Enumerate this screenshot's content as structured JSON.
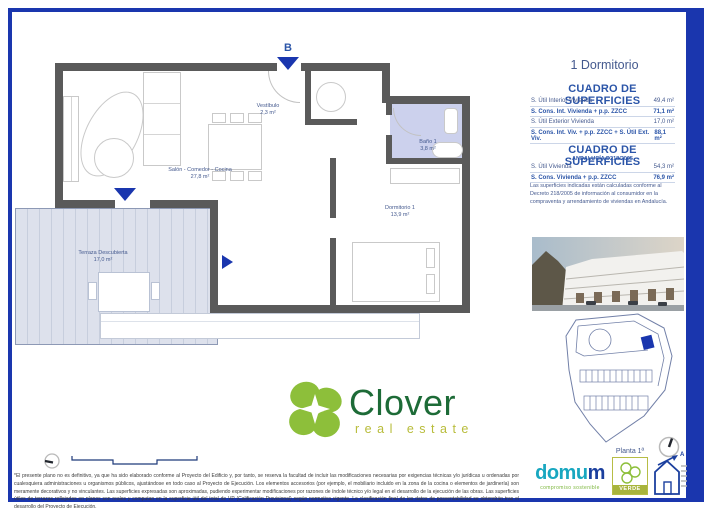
{
  "colors": {
    "frame_blue": "#1a36ae",
    "accent_blue": "#2b55a8",
    "label_blue": "#44598e",
    "wall_gray": "#5a5a5a",
    "bath_lavender": "#ccd1ed",
    "terrace_gray": "#dde1ec",
    "clover_green": "#8dbf3a",
    "clover_dark_green": "#1d6b37",
    "olive": "#b8bc3a",
    "domum_teal": "#18a7c0",
    "domum_blue": "#1b3f9e"
  },
  "header": {
    "unit_type": "1 Dormitorio"
  },
  "surfaces_table": {
    "title": "CUADRO DE SUPERFICIES",
    "rows": [
      {
        "label": "S. Útil Interior Vivienda",
        "value": "49,4 m²"
      },
      {
        "label": "S. Cons. Int. Vivienda + p.p. ZZCC",
        "value": "71,1 m²"
      },
      {
        "label": "S. Útil Exterior Vivienda",
        "value": "17,0 m²"
      },
      {
        "label": "S. Cons. Int. Viv. + p.p. ZZCC + S. Útil Ext. Viv.",
        "value": "88,1 m²"
      }
    ]
  },
  "andalucia_table": {
    "title": "CUADRO DE SUPERFICIES",
    "subtitle": "ANDALUCÍA D218/2005",
    "rows": [
      {
        "label": "S. Útil Vivienda",
        "value": "54,3 m²"
      },
      {
        "label": "S. Cons. Vivienda + p.p. ZZCC",
        "value": "76,9 m²"
      }
    ],
    "note": "Las superficies indicadas están calculadas conforme al Decreto 218/2005 de información al consumidor en la compraventa y arrendamiento de viviendas en Andalucía."
  },
  "floorplan": {
    "block_label": "B",
    "rooms": {
      "vestibulo": {
        "name": "Vestíbulo",
        "area": "2,3 m²"
      },
      "salon": {
        "name": "Salón - Comedor - Cocina",
        "area": "27,8 m²"
      },
      "bano": {
        "name": "Baño 1",
        "area": "3,8 m²"
      },
      "dormitorio": {
        "name": "Dormitorio 1",
        "area": "13,9 m²"
      },
      "terraza": {
        "name": "Terraza Descubierta",
        "area": "17,0 m²"
      }
    }
  },
  "siteplan": {
    "caption": "Planta 1ª"
  },
  "branding": {
    "clover_name": "Clover",
    "clover_tagline": "real estate",
    "domum_part1": "domu",
    "domum_part2": "m",
    "domum_tagline": "compromiso sostenible",
    "verde_label": "VERDE",
    "energy_label": "A"
  },
  "footer": {
    "disclaimer": "*El presente plano no es definitivo, ya que ha sido elaborado conforme al Proyecto del Edificio y, por tanto, se reserva la facultad de incluir las modificaciones necesarias por exigencias técnicas y/o jurídicas u ordenadas por cualesquiera administraciones u organismos públicos, ajustándose en todo caso al Proyecto de Ejecución. Los elementos accesorios (por ejemplo, el mobiliario incluido en la zona de la cocina o elementos de jardinería) son meramente decorativos y no vinculantes. Las superficies expresadas son aproximadas, pudiendo experimentar modificaciones por razones de índole técnico y/o legal en el desarrollo de la ejecución de las obras. Las superficies útiles de terrazas reflejadas en planos son reales y computan en la superficie útil del total de VP (Calificación Provisional) según normativa vigente. La clasificación final de los datos de posventabilidad se obtendrán tras el desarrollo del Proyecto de Ejecución."
  }
}
